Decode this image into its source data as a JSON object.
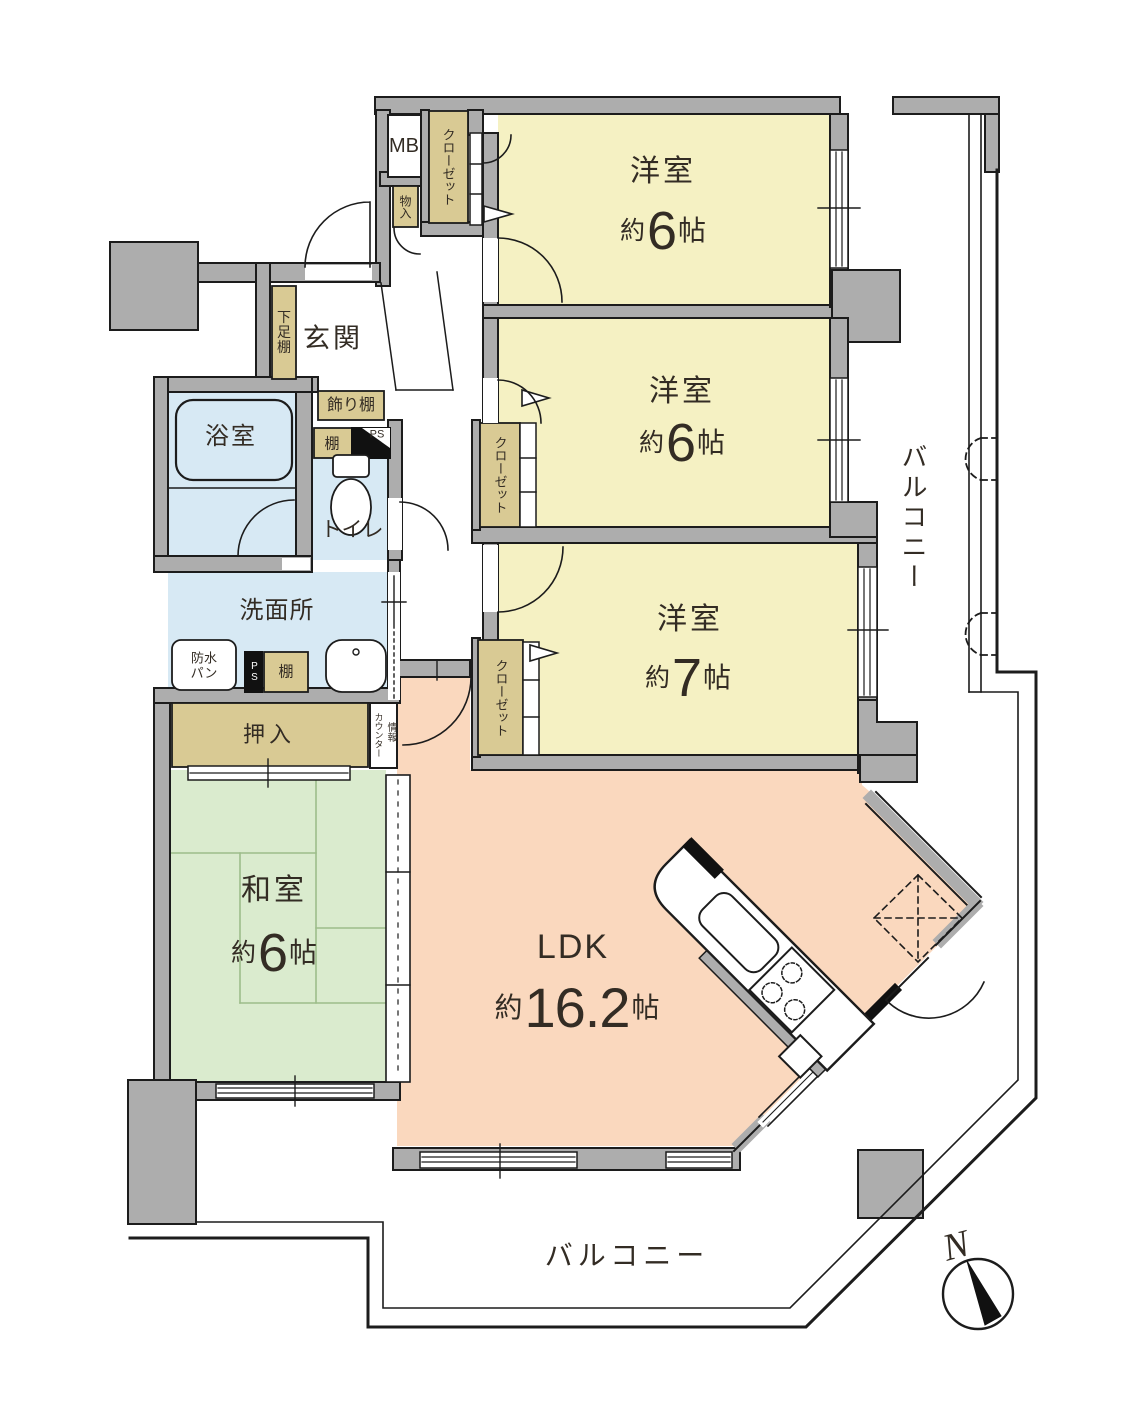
{
  "plan": {
    "rooms": {
      "bedroom1": {
        "name": "洋室",
        "approx": "約",
        "size": "6",
        "unit": "帖"
      },
      "bedroom2": {
        "name": "洋室",
        "approx": "約",
        "size": "6",
        "unit": "帖"
      },
      "bedroom3": {
        "name": "洋室",
        "approx": "約",
        "size": "7",
        "unit": "帖"
      },
      "japanese_room": {
        "name": "和室",
        "approx": "約",
        "size": "6",
        "unit": "帖"
      },
      "ldk": {
        "name": "LDK",
        "approx": "約",
        "size": "16.2",
        "unit": "帖"
      },
      "entrance": {
        "name": "玄関"
      },
      "bathroom": {
        "name": "浴室"
      },
      "washroom": {
        "name": "洗面所"
      },
      "toilet": {
        "name": "トイレ"
      },
      "balcony": {
        "name": "バルコニー"
      }
    },
    "fixtures": {
      "meter_box": "MB",
      "storage": "物入",
      "closet": "クローゼット",
      "shoe_shelf": "下足棚",
      "display_shelf": "飾り棚",
      "shelf": "棚",
      "pipe_space": "PS",
      "waterproof_pan_line1": "防水",
      "waterproof_pan_line2": "パン",
      "futon_closet": "押入",
      "counter": "カウンター",
      "info": "情報"
    },
    "compass": {
      "north": "N"
    },
    "colors": {
      "wall": "#ADADAD",
      "bedroom_fill": "#F5F1C3",
      "tatami_fill": "#DAEBCE",
      "ldk_fill": "#FAD8BE",
      "wet_fill": "#D7E9F4",
      "storage_fill": "#D9CA94"
    }
  }
}
